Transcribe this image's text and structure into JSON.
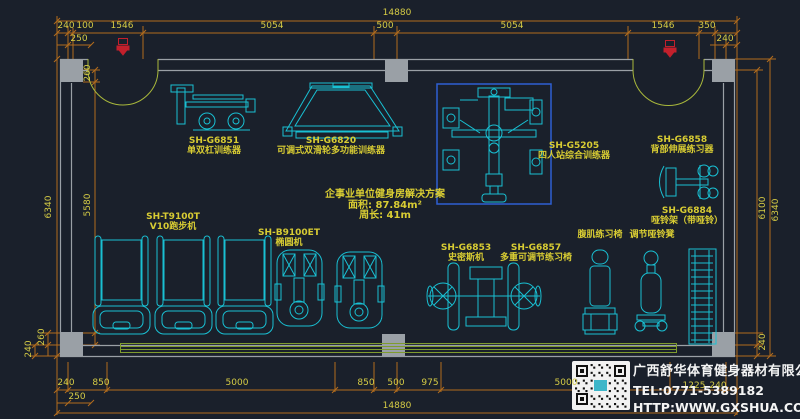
{
  "colors": {
    "background": "#1a202b",
    "wall": "#9aa0a6",
    "equipment": "#19c0d3",
    "label_yellow": "#d8cc33",
    "dimension_line": "#b36c1d",
    "dimension_text": "#d6cc45",
    "door": "#a9b83b",
    "floor_mat": "#7f9c2e",
    "selection_box": "#2e5fd3",
    "door_marker": "#c3202c",
    "company_text": "#f4f4f4"
  },
  "solution": {
    "line1": "企事业单位健身房解决方案",
    "line2": "面积: 87.84m²",
    "line3": "周长: 41m"
  },
  "company": {
    "name": "广西舒华体育健身器材有限公司",
    "tel": "TEL:0771-5389182",
    "website": "HTTP:WWW.GXSHUA.COM"
  },
  "equipment_labels": [
    {
      "model": "SH-G6851",
      "name": "单双杠训练器",
      "x": 214,
      "y": 136
    },
    {
      "model": "SH-G6820",
      "name": "可调式双滑轮多功能训练器",
      "x": 331,
      "y": 136
    },
    {
      "model": "SH-G5205",
      "name": "四人站综合训练器",
      "x": 574,
      "y": 141
    },
    {
      "model": "SH-G6858",
      "name": "背部伸展练习器",
      "x": 682,
      "y": 135
    },
    {
      "model": "SH-G6884",
      "name": "哑铃架（带哑铃）",
      "x": 687,
      "y": 206
    },
    {
      "model": "SH-T9100T",
      "name": "V10跑步机",
      "x": 173,
      "y": 212
    },
    {
      "model": "SH-B9100ET",
      "name": "椭圆机",
      "x": 289,
      "y": 228
    },
    {
      "model": "SH-G6853",
      "name": "史密斯机",
      "x": 466,
      "y": 243
    },
    {
      "model": "SH-G6857",
      "name": "多重可调节练习椅",
      "x": 536,
      "y": 243
    },
    {
      "model": "",
      "name": "腹肌练习椅",
      "x": 600,
      "y": 230
    },
    {
      "model": "",
      "name": "调节哑铃凳",
      "x": 652,
      "y": 230
    }
  ],
  "dimension_labels": [
    {
      "text": "14880",
      "x": 397,
      "y": 13,
      "rot": 0
    },
    {
      "text": "240",
      "x": 66,
      "y": 26,
      "rot": 0
    },
    {
      "text": "100",
      "x": 85,
      "y": 26,
      "rot": 0
    },
    {
      "text": "1546",
      "x": 122,
      "y": 26,
      "rot": 0
    },
    {
      "text": "5054",
      "x": 272,
      "y": 26,
      "rot": 0
    },
    {
      "text": "500",
      "x": 385,
      "y": 26,
      "rot": 0
    },
    {
      "text": "5054",
      "x": 512,
      "y": 26,
      "rot": 0
    },
    {
      "text": "1546",
      "x": 663,
      "y": 26,
      "rot": 0
    },
    {
      "text": "350",
      "x": 707,
      "y": 26,
      "rot": 0
    },
    {
      "text": "250",
      "x": 79,
      "y": 39,
      "rot": 0
    },
    {
      "text": "240",
      "x": 725,
      "y": 39,
      "rot": 0
    },
    {
      "text": "260",
      "x": 88,
      "y": 73,
      "rot": 90
    },
    {
      "text": "6340",
      "x": 49,
      "y": 207,
      "rot": 90
    },
    {
      "text": "5580",
      "x": 88,
      "y": 205,
      "rot": 90
    },
    {
      "text": "260",
      "x": 42,
      "y": 337,
      "rot": 90
    },
    {
      "text": "240",
      "x": 29,
      "y": 349,
      "rot": 90
    },
    {
      "text": "6100",
      "x": 763,
      "y": 208,
      "rot": 90
    },
    {
      "text": "6340",
      "x": 776,
      "y": 210,
      "rot": 90
    },
    {
      "text": "240",
      "x": 763,
      "y": 342,
      "rot": 90
    },
    {
      "text": "240",
      "x": 66,
      "y": 383,
      "rot": 0
    },
    {
      "text": "850",
      "x": 101,
      "y": 383,
      "rot": 0
    },
    {
      "text": "5000",
      "x": 237,
      "y": 383,
      "rot": 0
    },
    {
      "text": "850",
      "x": 366,
      "y": 383,
      "rot": 0
    },
    {
      "text": "500",
      "x": 396,
      "y": 383,
      "rot": 0
    },
    {
      "text": "975",
      "x": 430,
      "y": 383,
      "rot": 0
    },
    {
      "text": "5000",
      "x": 566,
      "y": 383,
      "rot": 0
    },
    {
      "text": "1225",
      "x": 694,
      "y": 386,
      "rot": 0
    },
    {
      "text": "240",
      "x": 718,
      "y": 386,
      "rot": 0
    },
    {
      "text": "250",
      "x": 77,
      "y": 397,
      "rot": 0
    },
    {
      "text": "14880",
      "x": 397,
      "y": 406,
      "rot": 0
    }
  ]
}
